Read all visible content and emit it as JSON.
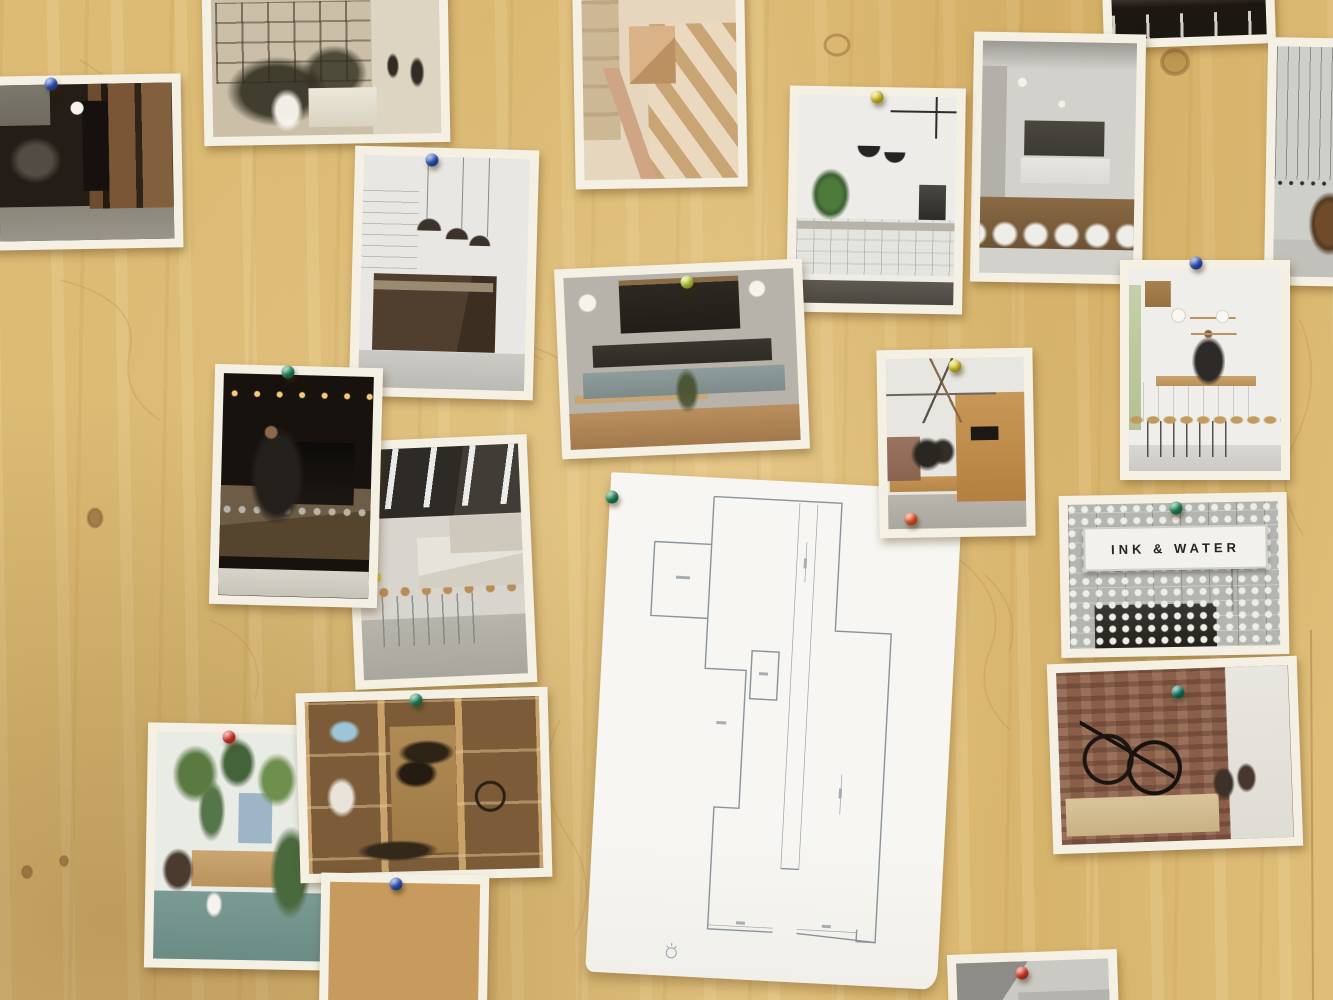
{
  "scene": {
    "description": "Photograph of a plywood mood board covered with pinned printed photos of cafe and bike-shop interiors, plus an architectural floor plan sheet",
    "board": {
      "material": "plywood",
      "base_color": "#dcbb74",
      "grain_color": "#b98c4c"
    }
  },
  "pin_colors": {
    "blue": "#2e55c0",
    "green": "#1f8a5c",
    "teal": "#0f7d68",
    "red": "#e23b2a",
    "orange": "#ef5a2c",
    "yellow": "#e3cf2e",
    "lime": "#c7d93e"
  },
  "photos": [
    {
      "id": "bike-room",
      "desc": "dark room with bikes hung on wall, wood panelling and doorway",
      "x": -10,
      "y": 75,
      "w": 192,
      "h": 174,
      "rot": -1,
      "pins": [
        {
          "color": "blue",
          "x": 51,
          "y": 84
        }
      ]
    },
    {
      "id": "glass-interior",
      "desc": "sepia interior with glass partition walls, plants and people",
      "x": 203,
      "y": -14,
      "w": 246,
      "h": 158,
      "rot": -1,
      "pins": []
    },
    {
      "id": "dark-chairs",
      "desc": "dark interior with white chairs",
      "x": 1103,
      "y": -16,
      "w": 172,
      "h": 62,
      "rot": -2,
      "pins": []
    },
    {
      "id": "grey-cafe",
      "desc": "grey cafe with bare bulbs, bottle shelves and set wooden tables",
      "x": 972,
      "y": 33,
      "w": 172,
      "h": 250,
      "rot": 1,
      "pins": []
    },
    {
      "id": "peg-wall",
      "desc": "grey wall with hanging cords, peg dots and a wooden chair",
      "x": 1266,
      "y": 38,
      "w": 100,
      "h": 248,
      "rot": 1,
      "pins": []
    },
    {
      "id": "wood-box",
      "desc": "hands holding a wooden box beside open stairs",
      "x": 574,
      "y": -10,
      "w": 172,
      "h": 198,
      "rot": -1,
      "pins": []
    },
    {
      "id": "white-tile-plant",
      "desc": "white tiled cafe counter with plant and black pendant lamps",
      "x": 788,
      "y": 87,
      "w": 176,
      "h": 226,
      "rot": 1,
      "pins": [
        {
          "color": "yellow",
          "x": 877,
          "y": 97
        }
      ]
    },
    {
      "id": "white-industrial",
      "desc": "white industrial cafe with dark angular counter and pendants",
      "x": 352,
      "y": 148,
      "w": 184,
      "h": 250,
      "rot": 1.5,
      "pins": [
        {
          "color": "blue",
          "x": 432,
          "y": 160
        }
      ]
    },
    {
      "id": "long-bar",
      "desc": "long bar with rows of stools under dark beamed ceiling",
      "x": 350,
      "y": 438,
      "w": 182,
      "h": 248,
      "rot": -2.5,
      "pins": []
    },
    {
      "id": "barista-dark",
      "desc": "barista working at dark counter under warm string lights",
      "x": 212,
      "y": 366,
      "w": 168,
      "h": 240,
      "rot": 1.5,
      "pins": [
        {
          "color": "green",
          "x": 288,
          "y": 372
        }
      ]
    },
    {
      "id": "menu-board",
      "desc": "cafe bar with large menu board, globe lamps and wooden tables",
      "x": 558,
      "y": 264,
      "w": 248,
      "h": 190,
      "rot": -2.5,
      "pins": [
        {
          "color": "lime",
          "x": 687,
          "y": 282
        }
      ]
    },
    {
      "id": "osb-room",
      "desc": "people seated by OSB wall under white truss roof",
      "x": 878,
      "y": 349,
      "w": 156,
      "h": 188,
      "rot": -1,
      "pins": [
        {
          "color": "yellow",
          "x": 955,
          "y": 366
        },
        {
          "color": "orange",
          "x": 911,
          "y": 519
        }
      ]
    },
    {
      "id": "barista-white",
      "desc": "barista pouring at white tiled bar with three stools",
      "x": 1120,
      "y": 260,
      "w": 170,
      "h": 220,
      "rot": 0,
      "pins": [
        {
          "color": "blue",
          "x": 1196,
          "y": 263
        }
      ]
    },
    {
      "id": "ink-water",
      "desc": "lightbox sign reading INK & WATER above coffee machine",
      "x": 1060,
      "y": 494,
      "w": 228,
      "h": 162,
      "rot": -1,
      "sign_text": "INK & WATER",
      "pins": [
        {
          "color": "green",
          "x": 1176,
          "y": 508
        }
      ]
    },
    {
      "id": "bikes-brick",
      "desc": "two bikes hung on brick wall above bench in cafe",
      "x": 1050,
      "y": 660,
      "w": 250,
      "h": 190,
      "rot": -2,
      "pins": [
        {
          "color": "teal",
          "x": 1178,
          "y": 692
        }
      ]
    },
    {
      "id": "plant-cafe",
      "desc": "cafe full of hanging plants with teal floor and watering can",
      "x": 146,
      "y": 724,
      "w": 186,
      "h": 245,
      "rot": 1,
      "pins": [
        {
          "color": "red",
          "x": 229,
          "y": 737
        }
      ]
    },
    {
      "id": "gear-shelves",
      "desc": "bike-shop shelving with blue bike, clothes, bags and wheel",
      "x": 298,
      "y": 690,
      "w": 252,
      "h": 190,
      "rot": -1.5,
      "pins": [
        {
          "color": "green",
          "x": 416,
          "y": 700
        }
      ]
    },
    {
      "id": "pendant-person",
      "desc": "person reaching up under black pendant lamp, OSB walls",
      "x": 320,
      "y": 874,
      "w": 168,
      "h": 150,
      "rot": 1,
      "pins": [
        {
          "color": "blue",
          "x": 396,
          "y": 884
        }
      ]
    },
    {
      "id": "partial-grey",
      "desc": "partially visible photo at bottom edge",
      "x": 948,
      "y": 952,
      "w": 170,
      "h": 70,
      "rot": -2,
      "pins": [
        {
          "color": "red",
          "x": 1022,
          "y": 973
        }
      ]
    }
  ],
  "floor_plan": {
    "desc": "white A3 sheet with thin-line architectural floor plan of the cafe space, small round logo at bottom left",
    "x": 598,
    "y": 481,
    "w": 352,
    "h": 500,
    "rot": 3,
    "pins": [
      {
        "color": "green",
        "x": 612,
        "y": 497
      }
    ]
  }
}
